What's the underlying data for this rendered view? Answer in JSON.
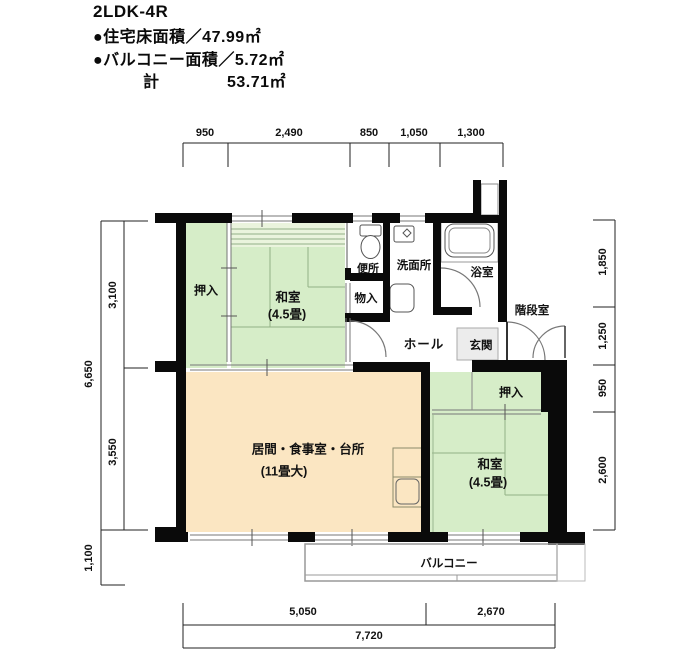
{
  "header": {
    "title": "2LDK-4R",
    "floor_area_line": "●住宅床面積／47.99㎡",
    "balcony_area_line": "●バルコニー面積／5.72㎡",
    "total_label": "計",
    "total_value": "53.71㎡"
  },
  "rooms": {
    "oshiire_top": "押入",
    "washitsu_top_name": "和室",
    "washitsu_top_size": "(4.5畳)",
    "toilet": "便所",
    "storage": "物入",
    "washroom": "洗面所",
    "bathroom": "浴室",
    "hall": "ホール",
    "entrance": "玄関",
    "stairwell": "階段室",
    "oshiire_bottom": "押入",
    "washitsu_bottom_name": "和室",
    "washitsu_bottom_size": "(4.5畳)",
    "ldk_name": "居間・食事室・台所",
    "ldk_size": "(11畳大)",
    "balcony": "バルコニー"
  },
  "dimensions": {
    "top": [
      "950",
      "2,490",
      "850",
      "1,050",
      "1,300"
    ],
    "left_inner": [
      "3,100",
      "3,550"
    ],
    "left_outer": [
      "6,650",
      "1,100"
    ],
    "right": [
      "1,850",
      "1,250",
      "950",
      "2,600"
    ],
    "bottom": [
      "5,050",
      "2,670"
    ],
    "bottom_total": "7,720"
  },
  "colors": {
    "tatami_green": "#d6edc8",
    "tatami_band": "#eaf4dd",
    "ldk_beige": "#fbe6c2",
    "wall_black": "#0a0a0a",
    "entry_tile": "#ececec"
  }
}
